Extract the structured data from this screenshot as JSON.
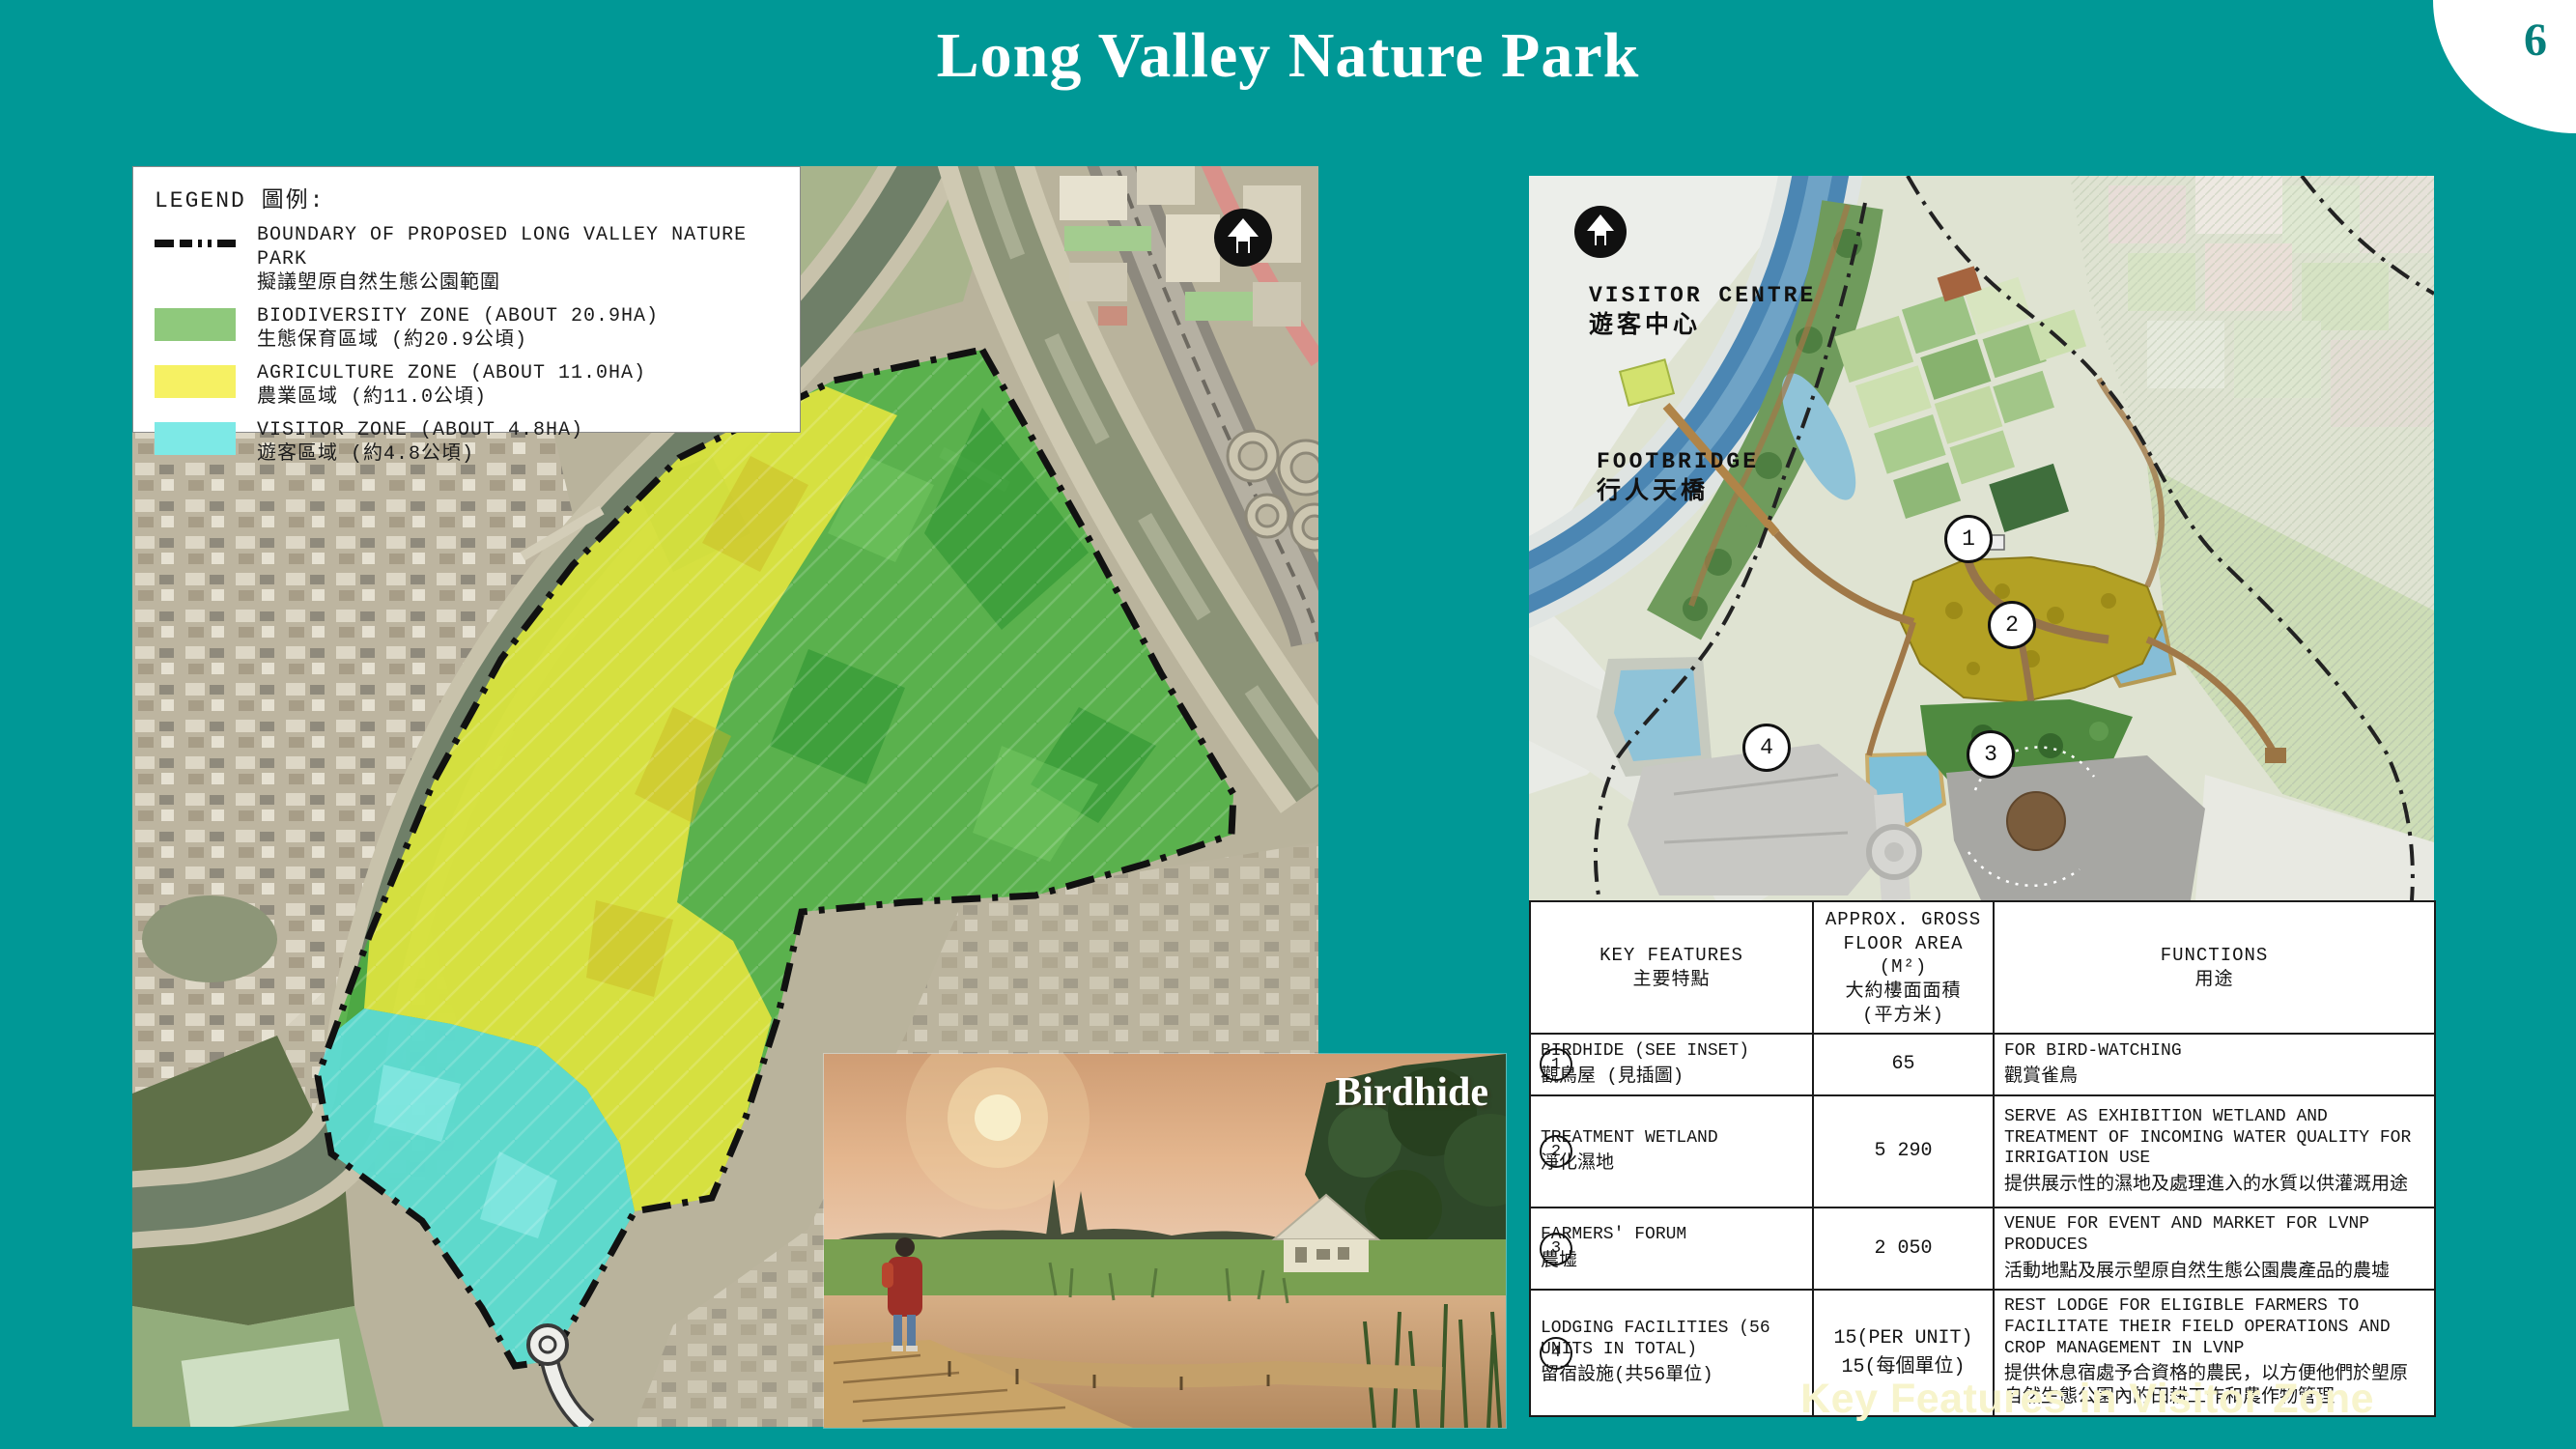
{
  "page": {
    "title": "Long Valley Nature Park",
    "number": "6",
    "caption": "Key Features in Visitor Zone"
  },
  "colors": {
    "background_teal": "#009896",
    "biodiversity_green": "#46b13c",
    "agriculture_yellow": "#ece93e",
    "visitor_cyan": "#5fdede",
    "wetland_olive": "#b3a124",
    "river_blue": "#4b86b3",
    "caption_text": "#f7f4cc"
  },
  "icons": {
    "north_arrow": "north-arrow-icon",
    "boundary_line": "dash-dot-line"
  },
  "legend": {
    "heading": "LEGEND  圖例:",
    "items": [
      {
        "label_en": "BOUNDARY OF PROPOSED LONG VALLEY NATURE PARK",
        "label_zh": "擬議塱原自然生態公園範圍"
      },
      {
        "label_en": "BIODIVERSITY ZONE (ABOUT 20.9HA)",
        "label_zh": "生態保育區域 (約20.9公頃)"
      },
      {
        "label_en": "AGRICULTURE ZONE (ABOUT 11.0HA)",
        "label_zh": "農業區域 (約11.0公頃)"
      },
      {
        "label_en": "VISITOR ZONE (ABOUT 4.8HA)",
        "label_zh": "遊客區域 (約4.8公頃)"
      }
    ]
  },
  "right_map": {
    "labels": {
      "visitor_centre_en": "VISITOR CENTRE",
      "visitor_centre_zh": "遊客中心",
      "footbridge_en": "FOOTBRIDGE",
      "footbridge_zh": "行人天橋"
    },
    "markers": [
      "1",
      "2",
      "3",
      "4"
    ]
  },
  "inset": {
    "label": "Birdhide"
  },
  "table": {
    "headers": {
      "features_en": "KEY FEATURES",
      "features_zh": "主要特點",
      "area_l1": "APPROX. GROSS",
      "area_l2": "FLOOR AREA (M²)",
      "area_zh1": "大約樓面面積",
      "area_zh2": "(平方米)",
      "functions_en": "FUNCTIONS",
      "functions_zh": "用途"
    },
    "rows": [
      {
        "num": "1",
        "feature_en": "BIRDHIDE (SEE INSET)",
        "feature_zh": "觀鳥屋 (見插圖)",
        "area": "65",
        "area2": "",
        "func_en": "FOR BIRD-WATCHING",
        "func_zh": "觀賞雀鳥"
      },
      {
        "num": "2",
        "feature_en": "TREATMENT WETLAND",
        "feature_zh": "淨化濕地",
        "area": "5 290",
        "area2": "",
        "func_en": "SERVE AS EXHIBITION WETLAND AND TREATMENT OF INCOMING WATER QUALITY FOR IRRIGATION USE",
        "func_zh": "提供展示性的濕地及處理進入的水質以供灌溉用途"
      },
      {
        "num": "3",
        "feature_en": "FARMERS' FORUM",
        "feature_zh": "農墟",
        "area": "2 050",
        "area2": "",
        "func_en": "VENUE FOR EVENT AND MARKET FOR LVNP PRODUCES",
        "func_zh": "活動地點及展示塱原自然生態公園農產品的農墟"
      },
      {
        "num": "4",
        "feature_en": "LODGING FACILITIES (56 UNITS IN TOTAL)",
        "feature_zh": "留宿設施(共56單位)",
        "area": "15(PER UNIT)",
        "area2": "15(每個單位)",
        "func_en": "REST LODGE FOR ELIGIBLE FARMERS TO FACILITATE THEIR FIELD OPERATIONS AND CROP MANAGEMENT IN LVNP",
        "func_zh": "提供休息宿處予合資格的農民，以方便他們於塱原自然生態公園內的田耕工作和農作物管理"
      }
    ]
  }
}
